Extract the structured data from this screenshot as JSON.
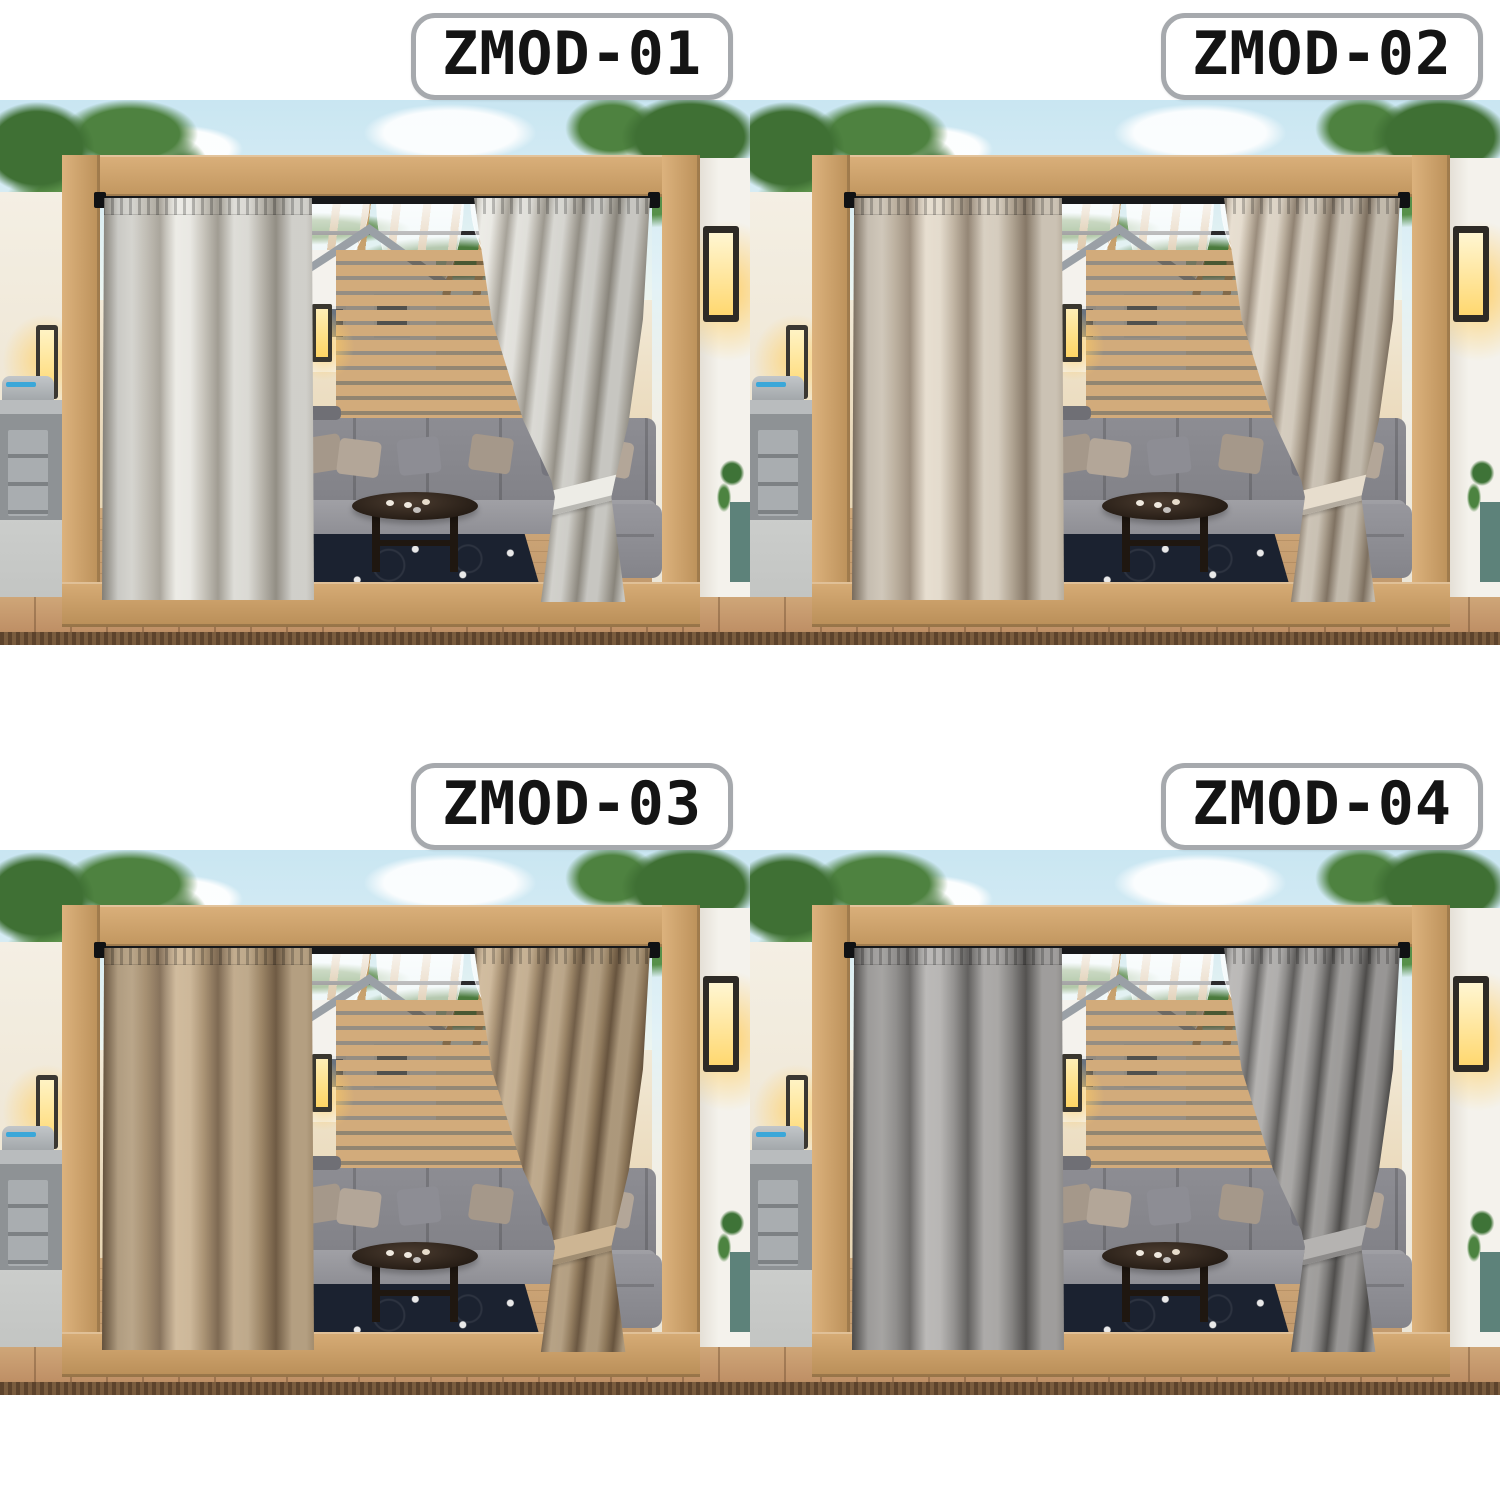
{
  "page": {
    "type": "product-variant-collage",
    "background": "#ffffff",
    "grid": "2x2"
  },
  "badge_style": {
    "background": "#ffffff",
    "border_color": "#a6a9ad",
    "text_color": "#141414"
  },
  "variants": [
    {
      "id": "zmod-01",
      "label": "ZMOD-01",
      "curtain_base": "#edece6",
      "curtain_fold": "#cac6bc",
      "curtain_deep": "#a39e93"
    },
    {
      "id": "zmod-02",
      "label": "ZMOD-02",
      "curtain_base": "#e7ddcd",
      "curtain_fold": "#c2b4a0",
      "curtain_deep": "#958572"
    },
    {
      "id": "zmod-03",
      "label": "ZMOD-03",
      "curtain_base": "#cdb593",
      "curtain_fold": "#a98f6c",
      "curtain_deep": "#7b644a"
    },
    {
      "id": "zmod-04",
      "label": "ZMOD-04",
      "curtain_base": "#b5b3b1",
      "curtain_fold": "#908e8c",
      "curtain_deep": "#5c5a58"
    }
  ],
  "scene": {
    "description": "Wooden pergola patio with two outdoor curtain panels (right panel tied back), sheer white voile swags under the rafters, gray L-shaped sectional sofa with pillows, round dark coffee table with cups, navy rug with white dots, wood deck, glowing wall lanterns, outdoor kitchen with grill at left, white pillar with lantern at right, trees and sky behind",
    "palette": {
      "sky": "#cde7f2",
      "cloud": "#ffffff",
      "foliage": "#4c7d3f",
      "wood_frame": "#c89a62",
      "rafters": "#c59a63",
      "deck": "#bf9066",
      "deck_edge": "#6b4f35",
      "back_wall": "#ead9ba",
      "slat_screen": "#d2ab7b",
      "house_wall": "#f4f2ed",
      "house_roof": "#9aa0a6",
      "sofa": "#8d8d93",
      "pillow_taupe": "#a5988a",
      "pillow_gray": "#75757d",
      "table": "#241b14",
      "rug": "#1b2230",
      "lamp_glow": "#ffd56e",
      "lamp_body": "#2e2b26",
      "voile": "#ffffff",
      "curtain_rod": "#17181a",
      "kitchen_gray": "#8e9295",
      "concrete": "#c7c9c8"
    }
  }
}
